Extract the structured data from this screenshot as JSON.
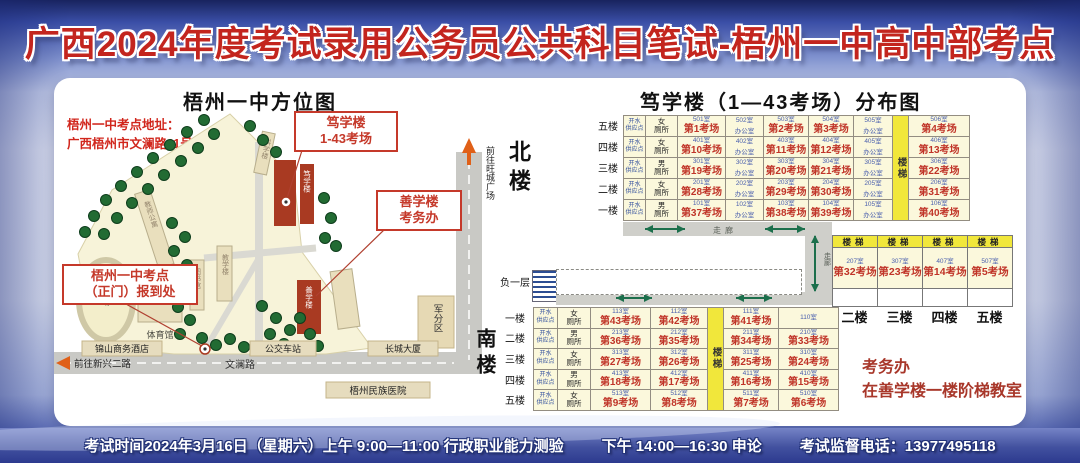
{
  "banner": {
    "title": "广西2024年度考试录用公务员公共科目笔试-梧州一中高中部考点"
  },
  "left_map": {
    "title": "梧州一中方位图",
    "address1": "梧州一中考点地址：",
    "address2": "广西梧州市文澜路11号",
    "callout_duxue1": "笃学楼",
    "callout_duxue2": "1-43考场",
    "callout_shanxue1": "善学楼",
    "callout_shanxue2": "考务办",
    "callout_gate1": "梧州一中考点",
    "callout_gate2": "（正门）报到处",
    "buildings": {
      "teacher": "教师公寓",
      "science": "科学楼",
      "teach": "教学楼",
      "library": "图书馆",
      "duxue": "笃学楼",
      "shanxue": "善学楼",
      "gym": "体育馆",
      "track": "运动场"
    },
    "ext": {
      "hotel": "锦山商务酒店",
      "bus": "公交车站",
      "tower": "长城大厦",
      "hospital": "梧州民族医院",
      "military": "军分区"
    },
    "roads": {
      "wenlan": "文澜路",
      "to_xinxing": "前往新兴二路",
      "to_wangcheng": "前往旺城广场"
    }
  },
  "right_diagram": {
    "title": "笃学楼（1—43考场）分布图",
    "north_label": "北楼",
    "south_label": "南楼",
    "basement_label": "负一层",
    "corridor_label": "走廊",
    "stairs_label": "楼梯",
    "water1": "开水",
    "water2": "供应点",
    "toilet_suffix": "厕所",
    "north_floors": [
      {
        "floor": "五楼",
        "toilet": "女",
        "cells": [
          {
            "room": "501室",
            "name": "第1考场"
          },
          {
            "room": "502室",
            "name": "办公室"
          },
          {
            "room": "503室",
            "name": "第2考场"
          },
          {
            "room": "504室",
            "name": "第3考场"
          },
          {
            "room": "505室",
            "name": "办公室"
          },
          {
            "room": "506室",
            "name": "第4考场"
          }
        ]
      },
      {
        "floor": "四楼",
        "toilet": "女",
        "cells": [
          {
            "room": "401室",
            "name": "第10考场"
          },
          {
            "room": "402室",
            "name": "办公室"
          },
          {
            "room": "403室",
            "name": "第11考场"
          },
          {
            "room": "404室",
            "name": "第12考场"
          },
          {
            "room": "405室",
            "name": "办公室"
          },
          {
            "room": "406室",
            "name": "第13考场"
          }
        ]
      },
      {
        "floor": "三楼",
        "toilet": "男",
        "cells": [
          {
            "room": "301室",
            "name": "第19考场"
          },
          {
            "room": "302室",
            "name": "办公室"
          },
          {
            "room": "303室",
            "name": "第20考场"
          },
          {
            "room": "304室",
            "name": "第21考场"
          },
          {
            "room": "305室",
            "name": "办公室"
          },
          {
            "room": "306室",
            "name": "第22考场"
          }
        ]
      },
      {
        "floor": "二楼",
        "toilet": "女",
        "cells": [
          {
            "room": "201室",
            "name": "第28考场"
          },
          {
            "room": "202室",
            "name": "办公室"
          },
          {
            "room": "203室",
            "name": "第29考场"
          },
          {
            "room": "204室",
            "name": "第30考场"
          },
          {
            "room": "205室",
            "name": "办公室"
          },
          {
            "room": "206室",
            "name": "第31考场"
          }
        ]
      },
      {
        "floor": "一楼",
        "toilet": "男",
        "cells": [
          {
            "room": "101室",
            "name": "第37考场"
          },
          {
            "room": "102室",
            "name": "办公室"
          },
          {
            "room": "103室",
            "name": "第38考场"
          },
          {
            "room": "104室",
            "name": "第39考场"
          },
          {
            "room": "105室",
            "name": "办公室"
          },
          {
            "room": "106室",
            "name": "第40考场"
          }
        ]
      }
    ],
    "middle": {
      "floors": [
        "二楼",
        "三楼",
        "四楼",
        "五楼"
      ],
      "cells": [
        {
          "room": "207室",
          "name": "第32考场"
        },
        {
          "room": "307室",
          "name": "第23考场"
        },
        {
          "room": "407室",
          "name": "第14考场"
        },
        {
          "room": "507室",
          "name": "第5考场"
        }
      ]
    },
    "south_floors": [
      {
        "floor": "一楼",
        "toilet": "女",
        "cells": [
          {
            "room": "113室",
            "name": "第43考场"
          },
          {
            "room": "112室",
            "name": "第42考场"
          },
          {
            "room": "111室",
            "name": "第41考场"
          },
          {
            "room": "110室",
            "name": ""
          }
        ]
      },
      {
        "floor": "二楼",
        "toilet": "男",
        "cells": [
          {
            "room": "213室",
            "name": "第36考场"
          },
          {
            "room": "212室",
            "name": "第35考场"
          },
          {
            "room": "211室",
            "name": "第34考场"
          },
          {
            "room": "210室",
            "name": "第33考场"
          }
        ]
      },
      {
        "floor": "三楼",
        "toilet": "女",
        "cells": [
          {
            "room": "313室",
            "name": "第27考场"
          },
          {
            "room": "312室",
            "name": "第26考场"
          },
          {
            "room": "311室",
            "name": "第25考场"
          },
          {
            "room": "310室",
            "name": "第24考场"
          }
        ]
      },
      {
        "floor": "四楼",
        "toilet": "男",
        "cells": [
          {
            "room": "413室",
            "name": "第18考场"
          },
          {
            "room": "412室",
            "name": "第17考场"
          },
          {
            "room": "411室",
            "name": "第16考场"
          },
          {
            "room": "410室",
            "name": "第15考场"
          }
        ]
      },
      {
        "floor": "五楼",
        "toilet": "女",
        "cells": [
          {
            "room": "513室",
            "name": "第9考场"
          },
          {
            "room": "512室",
            "name": "第8考场"
          },
          {
            "room": "511室",
            "name": "第7考场"
          },
          {
            "room": "510室",
            "name": "第6考场"
          }
        ]
      }
    ],
    "kaowuban1": "考务办",
    "kaowuban2": "在善学楼一楼阶梯教室"
  },
  "footer": {
    "part1": "考试时间2024年3月16日（星期六）上午 9:00—11:00 行政职业能力测验",
    "part2": "下午 14:00—16:30 申论",
    "part3": "考试监督电话：13977495118"
  }
}
